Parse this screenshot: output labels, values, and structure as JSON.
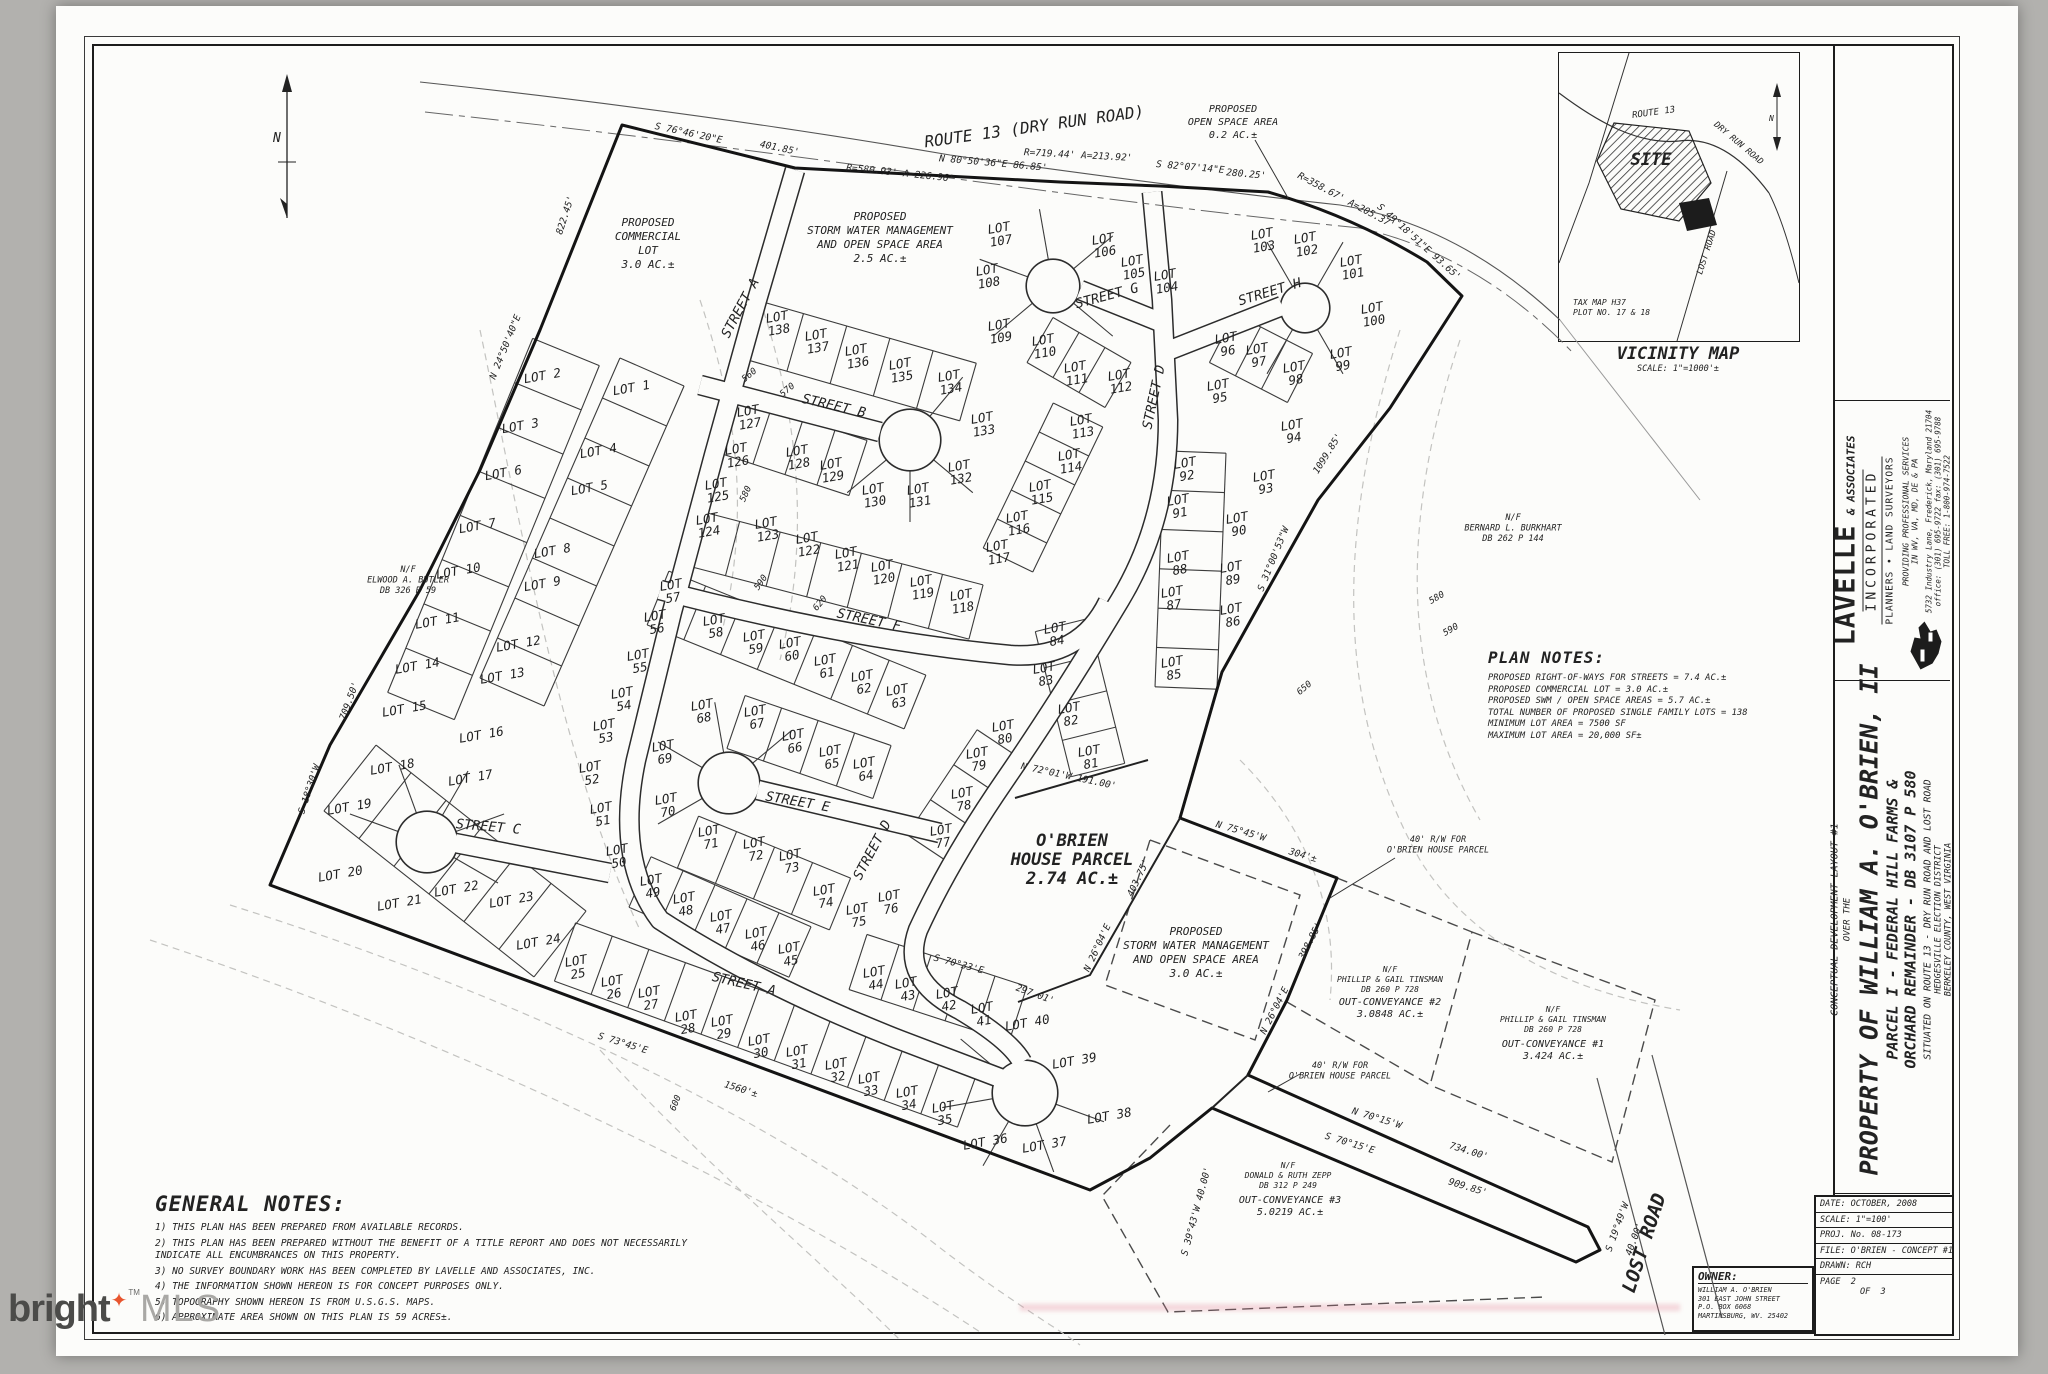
{
  "watermark": {
    "brand": "bright",
    "tm": "TM",
    "suffix": "MLS"
  },
  "title_block": {
    "firm_name": "LAVELLE",
    "firm_amp": "& ASSOCIATES",
    "firm_inc": "INCORPORATED",
    "firm_sub": "PLANNERS • LAND SURVEYORS",
    "services1": "PROVIDING PROFESSIONAL SERVICES",
    "services2": "IN WV, VA, MD, DE & PA",
    "address": "5732 Industry Lane, Frederick, Maryland 21704",
    "phones": "office: (301) 695-9722  fax: (301) 695-9788",
    "tollfree": "TOLL FREE: 1-800-974-7522",
    "small_title": "CONCEPTUAL DEVELOPMENT LAYOUT #1",
    "over": "OVER THE",
    "main_title": "PROPERTY OF WILLIAM A. O'BRIEN, II",
    "sub1": "PARCEL I - FEDERAL HILL FARMS &",
    "sub2": "ORCHARD REMAINDER - DB 3107 P 580",
    "situated": "SITUATED ON ROUTE 13 - DRY RUN ROAD AND LOST ROAD",
    "district": "HEDGESVILLE ELECTION DISTRICT",
    "county": "BERKELEY COUNTY, WEST VIRGINIA"
  },
  "info": {
    "rows": [
      {
        "label": "DATE:",
        "value": "OCTOBER, 2008"
      },
      {
        "label": "SCALE:",
        "value": "1\"=100'"
      },
      {
        "label": "PROJ. No.",
        "value": "08-173"
      },
      {
        "label": "FILE:",
        "value": "O'BRIEN - CONCEPT #1"
      },
      {
        "label": "DRAWN:",
        "value": "RCH"
      }
    ],
    "page": {
      "label": "PAGE",
      "num": "2",
      "of": "OF",
      "total": "3"
    }
  },
  "owner": {
    "heading": "OWNER:",
    "lines": [
      "WILLIAM A. O'BRIEN",
      "301 EAST JOHN STREET",
      "P.O. BOX 6068",
      "MARTINSBURG, WV. 25402"
    ]
  },
  "vicinity": {
    "title": "VICINITY MAP",
    "scale": "SCALE: 1\"=1000'±",
    "site": "SITE",
    "tax1": "TAX MAP H37",
    "tax2": "PLOT NO. 17 & 18",
    "route13": "ROUTE 13",
    "dry_run": "DRY RUN ROAD",
    "lost": "LOST ROAD"
  },
  "general_notes": {
    "heading": "GENERAL NOTES:",
    "items": [
      "1) THIS PLAN HAS BEEN PREPARED FROM AVAILABLE RECORDS.",
      "2) THIS PLAN HAS BEEN PREPARED WITHOUT THE BENEFIT OF A TITLE REPORT AND DOES NOT NECESSARILY INDICATE ALL ENCUMBRANCES ON THIS PROPERTY.",
      "3) NO SURVEY BOUNDARY WORK HAS BEEN COMPLETED BY LAVELLE AND ASSOCIATES, INC.",
      "4) THE INFORMATION SHOWN HEREON IS FOR CONCEPT PURPOSES ONLY.",
      "5) TOPOGRAPHY SHOWN HEREON IS FROM U.S.G.S. MAPS.",
      "6) APPROXIMATE AREA SHOWN ON THIS PLAN IS 59 ACRES±."
    ]
  },
  "plan_notes": {
    "heading": "PLAN NOTES:",
    "items": [
      "PROPOSED RIGHT-OF-WAYS FOR STREETS = 7.4 AC.±",
      "PROPOSED COMMERCIAL LOT = 3.0 AC.±",
      "PROPOSED SWM / OPEN SPACE AREAS = 5.7 AC.±",
      "TOTAL NUMBER OF PROPOSED SINGLE FAMILY LOTS = 138",
      "MINIMUM LOT AREA = 7500 SF",
      "MAXIMUM LOT AREA = 20,000 SF±"
    ]
  },
  "plat": {
    "road_label": "ROUTE 13   (DRY RUN ROAD)",
    "lost_road_label": "LOST ROAD",
    "lots": [
      [
        1,
        632,
        392,
        1
      ],
      [
        2,
        543,
        380,
        1
      ],
      [
        3,
        521,
        430,
        1
      ],
      [
        4,
        599,
        455,
        1
      ],
      [
        5,
        590,
        492,
        1
      ],
      [
        6,
        504,
        477,
        1
      ],
      [
        7,
        478,
        530,
        1
      ],
      [
        8,
        553,
        555,
        1
      ],
      [
        9,
        543,
        588,
        1
      ],
      [
        10,
        459,
        575,
        1
      ],
      [
        11,
        438,
        625,
        1
      ],
      [
        12,
        519,
        648,
        1
      ],
      [
        13,
        503,
        680,
        1
      ],
      [
        14,
        418,
        670,
        1
      ],
      [
        15,
        405,
        713,
        1
      ],
      [
        16,
        482,
        739,
        1
      ],
      [
        17,
        471,
        782,
        1
      ],
      [
        18,
        393,
        771,
        1
      ],
      [
        19,
        350,
        811,
        1
      ],
      [
        20,
        341,
        878,
        1
      ],
      [
        21,
        400,
        907,
        1
      ],
      [
        22,
        457,
        893,
        1
      ],
      [
        23,
        512,
        904,
        1
      ],
      [
        24,
        539,
        946,
        1
      ],
      [
        25,
        577,
        968,
        0
      ],
      [
        26,
        613,
        988,
        0
      ],
      [
        27,
        650,
        999,
        0
      ],
      [
        28,
        687,
        1023,
        0
      ],
      [
        29,
        723,
        1028,
        0
      ],
      [
        30,
        760,
        1047,
        0
      ],
      [
        31,
        798,
        1058,
        0
      ],
      [
        32,
        837,
        1071,
        0
      ],
      [
        33,
        870,
        1085,
        0
      ],
      [
        34,
        908,
        1099,
        0
      ],
      [
        35,
        944,
        1114,
        0
      ],
      [
        36,
        986,
        1146,
        1
      ],
      [
        37,
        1045,
        1149,
        1
      ],
      [
        38,
        1110,
        1120,
        1
      ],
      [
        39,
        1075,
        1065,
        1
      ],
      [
        40,
        1028,
        1027,
        1
      ],
      [
        41,
        983,
        1015,
        0
      ],
      [
        42,
        948,
        1000,
        0
      ],
      [
        43,
        907,
        990,
        0
      ],
      [
        44,
        875,
        979,
        0
      ],
      [
        45,
        790,
        955,
        0
      ],
      [
        46,
        757,
        940,
        0
      ],
      [
        47,
        722,
        923,
        0
      ],
      [
        48,
        685,
        905,
        0
      ],
      [
        49,
        652,
        887,
        0
      ],
      [
        50,
        618,
        857,
        0
      ],
      [
        51,
        602,
        815,
        0
      ],
      [
        52,
        591,
        774,
        0
      ],
      [
        53,
        605,
        732,
        0
      ],
      [
        54,
        623,
        700,
        0
      ],
      [
        55,
        639,
        662,
        0
      ],
      [
        56,
        656,
        623,
        0
      ],
      [
        57,
        672,
        592,
        0
      ],
      [
        58,
        715,
        627,
        0
      ],
      [
        59,
        755,
        643,
        0
      ],
      [
        60,
        791,
        650,
        0
      ],
      [
        61,
        826,
        667,
        0
      ],
      [
        62,
        863,
        683,
        0
      ],
      [
        63,
        898,
        697,
        0
      ],
      [
        64,
        865,
        770,
        0
      ],
      [
        65,
        831,
        758,
        0
      ],
      [
        66,
        794,
        742,
        0
      ],
      [
        67,
        756,
        718,
        0
      ],
      [
        68,
        703,
        712,
        0
      ],
      [
        69,
        664,
        753,
        0
      ],
      [
        70,
        667,
        806,
        0
      ],
      [
        71,
        710,
        838,
        0
      ],
      [
        72,
        755,
        850,
        0
      ],
      [
        73,
        791,
        862,
        0
      ],
      [
        74,
        825,
        897,
        0
      ],
      [
        75,
        858,
        916,
        0
      ],
      [
        76,
        890,
        903,
        0
      ],
      [
        77,
        942,
        837,
        0
      ],
      [
        78,
        963,
        800,
        0
      ],
      [
        79,
        978,
        760,
        0
      ],
      [
        80,
        1004,
        733,
        0
      ],
      [
        81,
        1090,
        758,
        0
      ],
      [
        82,
        1070,
        715,
        0
      ],
      [
        83,
        1045,
        675,
        0
      ],
      [
        84,
        1056,
        635,
        0
      ],
      [
        85,
        1173,
        669,
        0
      ],
      [
        86,
        1232,
        616,
        0
      ],
      [
        87,
        1173,
        599,
        0
      ],
      [
        88,
        1179,
        564,
        0
      ],
      [
        89,
        1232,
        574,
        0
      ],
      [
        90,
        1238,
        525,
        0
      ],
      [
        91,
        1179,
        507,
        0
      ],
      [
        92,
        1186,
        470,
        0
      ],
      [
        93,
        1265,
        483,
        0
      ],
      [
        94,
        1293,
        432,
        0
      ],
      [
        95,
        1219,
        392,
        0
      ],
      [
        96,
        1227,
        345,
        0
      ],
      [
        97,
        1258,
        356,
        0
      ],
      [
        98,
        1295,
        374,
        0
      ],
      [
        99,
        1342,
        360,
        0
      ],
      [
        100,
        1373,
        315,
        0
      ],
      [
        101,
        1352,
        268,
        0
      ],
      [
        102,
        1306,
        245,
        0
      ],
      [
        103,
        1263,
        241,
        0
      ],
      [
        104,
        1166,
        282,
        0
      ],
      [
        105,
        1133,
        268,
        0
      ],
      [
        106,
        1104,
        246,
        0
      ],
      [
        107,
        1000,
        235,
        0
      ],
      [
        108,
        988,
        277,
        0
      ],
      [
        109,
        1000,
        332,
        0
      ],
      [
        110,
        1044,
        347,
        0
      ],
      [
        111,
        1076,
        374,
        0
      ],
      [
        112,
        1120,
        382,
        0
      ],
      [
        113,
        1082,
        427,
        0
      ],
      [
        114,
        1070,
        462,
        0
      ],
      [
        115,
        1041,
        493,
        0
      ],
      [
        116,
        1018,
        524,
        0
      ],
      [
        117,
        998,
        553,
        0
      ],
      [
        118,
        962,
        602,
        0
      ],
      [
        119,
        922,
        588,
        0
      ],
      [
        120,
        883,
        573,
        0
      ],
      [
        121,
        847,
        560,
        0
      ],
      [
        122,
        808,
        545,
        0
      ],
      [
        123,
        767,
        530,
        0
      ],
      [
        124,
        708,
        526,
        0
      ],
      [
        125,
        717,
        491,
        0
      ],
      [
        126,
        737,
        456,
        0
      ],
      [
        127,
        749,
        418,
        0
      ],
      [
        128,
        798,
        458,
        0
      ],
      [
        129,
        832,
        471,
        0
      ],
      [
        130,
        874,
        496,
        0
      ],
      [
        131,
        919,
        496,
        0
      ],
      [
        132,
        960,
        473,
        0
      ],
      [
        133,
        983,
        425,
        0
      ],
      [
        134,
        950,
        383,
        0
      ],
      [
        135,
        901,
        371,
        0
      ],
      [
        136,
        857,
        357,
        0
      ],
      [
        137,
        817,
        342,
        0
      ],
      [
        138,
        778,
        324,
        0
      ]
    ],
    "streets": [
      [
        "STREET A",
        744,
        310,
        -62
      ],
      [
        "STREET A",
        743,
        988,
        13
      ],
      [
        "STREET B",
        833,
        410,
        13
      ],
      [
        "STREET C",
        488,
        831,
        5
      ],
      [
        "STREET D",
        1158,
        398,
        -78
      ],
      [
        "STREET D",
        876,
        852,
        -62
      ],
      [
        "STREET E",
        797,
        806,
        10
      ],
      [
        "STREET F",
        868,
        624,
        12
      ],
      [
        "STREET G",
        1108,
        300,
        -15
      ],
      [
        "STREET H",
        1271,
        296,
        -17
      ]
    ],
    "bearings": [
      [
        "S 76°46'20\"E",
        688,
        136,
        12
      ],
      [
        "401.85'",
        779,
        151,
        12
      ],
      [
        "R=580.93' A=226.96'",
        900,
        176,
        6
      ],
      [
        "N 80°50'36\"E 86.85'",
        993,
        166,
        5
      ],
      [
        "R=719.44' A=213.92'",
        1078,
        158,
        3
      ],
      [
        "S 82°07'14\"E",
        1190,
        170,
        5
      ],
      [
        "280.25'",
        1246,
        177,
        5
      ],
      [
        "R=358.67' A=205.37'",
        1345,
        203,
        28
      ],
      [
        "S 49°18'51\"E 93.65'",
        1417,
        244,
        42
      ],
      [
        "822.45'",
        568,
        216,
        -72
      ],
      [
        "N 24°50'40\"E",
        508,
        348,
        -68
      ],
      [
        "S 18°30'W",
        312,
        790,
        -72
      ],
      [
        "709.50'",
        352,
        702,
        -70
      ],
      [
        "S 73°45'E",
        622,
        1046,
        17
      ],
      [
        "1560'±",
        740,
        1092,
        17
      ],
      [
        "S 70°33'E",
        958,
        967,
        15
      ],
      [
        "297.01'",
        1034,
        997,
        20
      ],
      [
        "N 72°01'W 191.00'",
        1068,
        779,
        12
      ],
      [
        "N 75°45'W",
        1240,
        834,
        16
      ],
      [
        "304'±",
        1302,
        858,
        16
      ],
      [
        "403.75'",
        1141,
        879,
        -65
      ],
      [
        "N 26°04'E",
        1100,
        949,
        -65
      ],
      [
        "398.85'",
        1313,
        942,
        -63
      ],
      [
        "N 26°04'E",
        1277,
        1012,
        -63
      ],
      [
        "1099.85'",
        1330,
        455,
        -58
      ],
      [
        "S 31°00'53\"W",
        1276,
        560,
        -68
      ],
      [
        "N 70°15'W",
        1376,
        1121,
        17
      ],
      [
        "734.00'",
        1468,
        1154,
        17
      ],
      [
        "S 70°15'E",
        1349,
        1146,
        17
      ],
      [
        "909.85'",
        1467,
        1190,
        17
      ],
      [
        "S 19°49'W",
        1620,
        1228,
        -70
      ],
      [
        "40.00'",
        1637,
        1240,
        -70
      ],
      [
        "S 39°43'W 40.00'",
        1199,
        1212,
        -75
      ]
    ],
    "contour_labels": [
      [
        "560",
        751,
        377,
        -40
      ],
      [
        "570",
        789,
        392,
        -40
      ],
      [
        "580",
        748,
        495,
        -65
      ],
      [
        "590",
        763,
        584,
        -55
      ],
      [
        "620",
        822,
        605,
        -50
      ],
      [
        "600",
        678,
        1104,
        -68
      ],
      [
        "650",
        1306,
        690,
        -40
      ],
      [
        "580",
        1438,
        600,
        -30
      ],
      [
        "590",
        1452,
        632,
        -30
      ]
    ],
    "parcels": [
      {
        "lines": [
          "PROPOSED",
          "COMMERCIAL",
          "LOT",
          "3.0 AC.±"
        ],
        "x": 648,
        "y": 226,
        "fs": 11,
        "lh": 14
      },
      {
        "lines": [
          "PROPOSED",
          "STORM WATER MANAGEMENT",
          "AND OPEN SPACE AREA",
          "2.5 AC.±"
        ],
        "x": 880,
        "y": 220,
        "fs": 11,
        "lh": 14
      },
      {
        "lines": [
          "PROPOSED",
          "OPEN SPACE AREA",
          "0.2 AC.±"
        ],
        "x": 1233,
        "y": 112,
        "fs": 10,
        "lh": 13
      },
      {
        "lines": [
          "PROPOSED",
          "STORM WATER MANAGEMENT",
          "AND OPEN SPACE AREA",
          "3.0 AC.±"
        ],
        "x": 1196,
        "y": 935,
        "fs": 11,
        "lh": 14
      },
      {
        "lines": [
          "O'BRIEN",
          "HOUSE PARCEL",
          "2.74 AC.±"
        ],
        "x": 1072,
        "y": 846,
        "fs": 17,
        "lh": 19,
        "big": 1
      },
      {
        "lines": [
          "N/F",
          "PHILLIP & GAIL TINSMAN",
          "DB 260 P 728"
        ],
        "x": 1390,
        "y": 972,
        "fs": 8,
        "lh": 10
      },
      {
        "lines": [
          "OUT-CONVEYANCE #2",
          "3.0848 AC.±"
        ],
        "x": 1390,
        "y": 1005,
        "fs": 10,
        "lh": 12
      },
      {
        "lines": [
          "N/F",
          "PHILLIP & GAIL TINSMAN",
          "DB 260 P 728"
        ],
        "x": 1553,
        "y": 1012,
        "fs": 8,
        "lh": 10
      },
      {
        "lines": [
          "OUT-CONVEYANCE #1",
          "3.424 AC.±"
        ],
        "x": 1553,
        "y": 1047,
        "fs": 10,
        "lh": 12
      },
      {
        "lines": [
          "N/F",
          "DONALD & RUTH ZEPP",
          "DB 312 P 249"
        ],
        "x": 1288,
        "y": 1168,
        "fs": 8,
        "lh": 10
      },
      {
        "lines": [
          "OUT-CONVEYANCE #3",
          "5.0219 AC.±"
        ],
        "x": 1290,
        "y": 1203,
        "fs": 10,
        "lh": 12
      },
      {
        "lines": [
          "N/F",
          "ELWOOD A. BUTLER",
          "DB 326 P 59"
        ],
        "x": 408,
        "y": 572,
        "fs": 8.5,
        "lh": 10.5
      },
      {
        "lines": [
          "N/F",
          "BERNARD L. BURKHART",
          "DB 262 P 144"
        ],
        "x": 1513,
        "y": 520,
        "fs": 8.5,
        "lh": 10.5
      },
      {
        "lines": [
          "40' R/W FOR",
          "O'BRIEN HOUSE PARCEL"
        ],
        "x": 1438,
        "y": 842,
        "fs": 8.5,
        "lh": 10.5
      },
      {
        "lines": [
          "40' R/W FOR",
          "O'BRIEN HOUSE PARCEL"
        ],
        "x": 1340,
        "y": 1068,
        "fs": 8.5,
        "lh": 10.5
      }
    ]
  }
}
